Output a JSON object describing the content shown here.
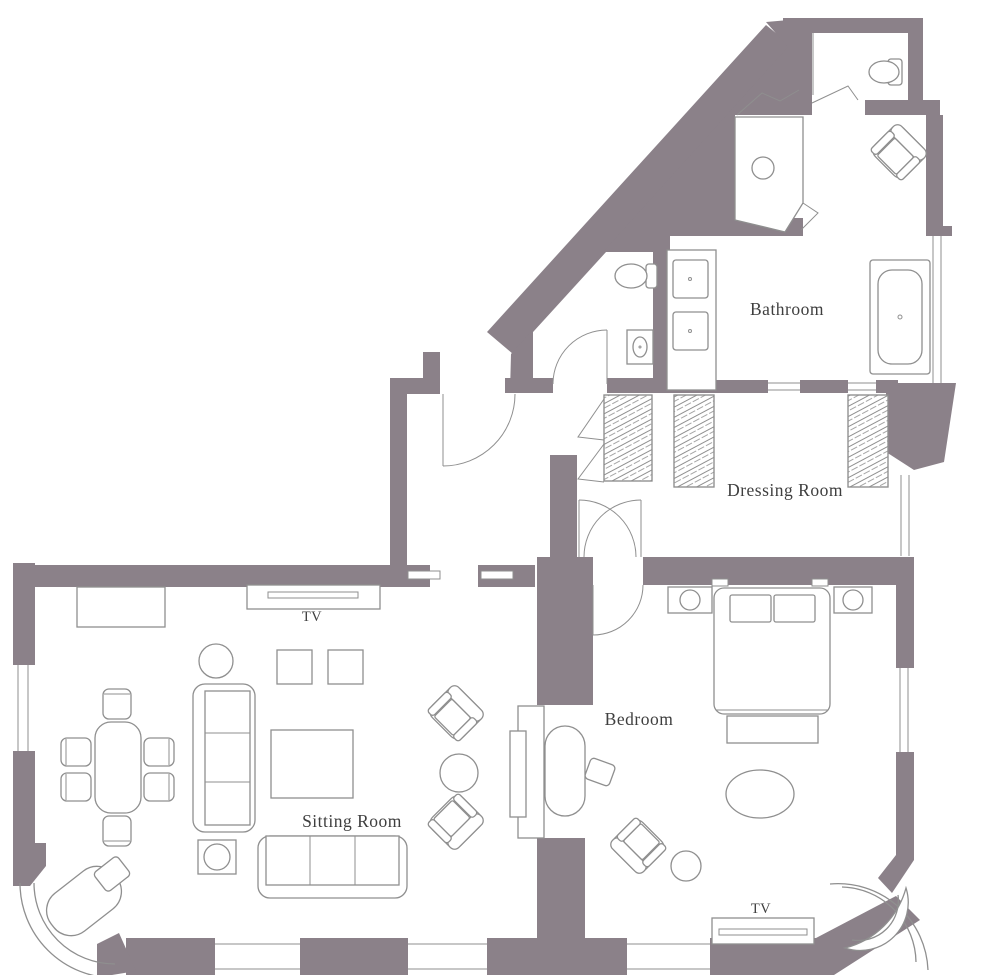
{
  "floor_plan": {
    "colors": {
      "wall": "#8b8189",
      "furniture_line": "#8f8f8f",
      "label_text": "#3f3f3f",
      "background": "#ffffff"
    },
    "labels": {
      "bathroom": "Bathroom",
      "dressing_room": "Dressing Room",
      "bedroom": "Bedroom",
      "sitting_room": "Sitting Room",
      "sitting_room_tv": "TV",
      "bedroom_tv": "TV"
    }
  }
}
